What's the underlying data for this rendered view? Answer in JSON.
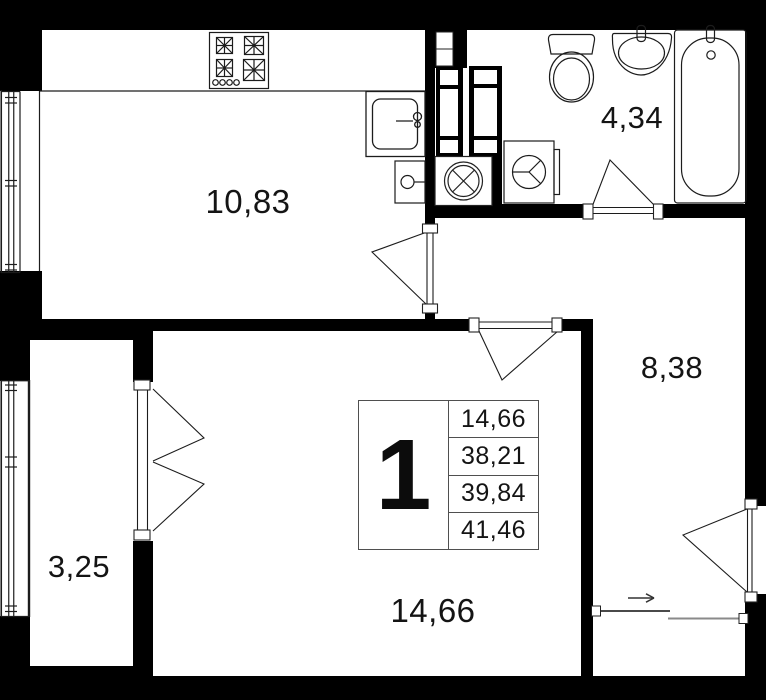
{
  "plan": {
    "colors": {
      "wall": "#000000",
      "line": "#1c1c1c",
      "background": "#ffffff"
    },
    "unit": {
      "number": "1",
      "stats": [
        "14,66",
        "38,21",
        "39,84",
        "41,46"
      ]
    },
    "rooms": {
      "kitchen": {
        "area": "10,83"
      },
      "bathroom": {
        "area": "4,34"
      },
      "hallway": {
        "area": "8,38"
      },
      "living_room": {
        "area": "14,66"
      },
      "balcony": {
        "area": "3,25"
      }
    },
    "fixtures": [
      "stove",
      "kitchen-sink",
      "boiler",
      "vent-fan",
      "washing-machine",
      "toilet",
      "wash-basin",
      "bathtub"
    ],
    "entrance_arrow": "→"
  }
}
